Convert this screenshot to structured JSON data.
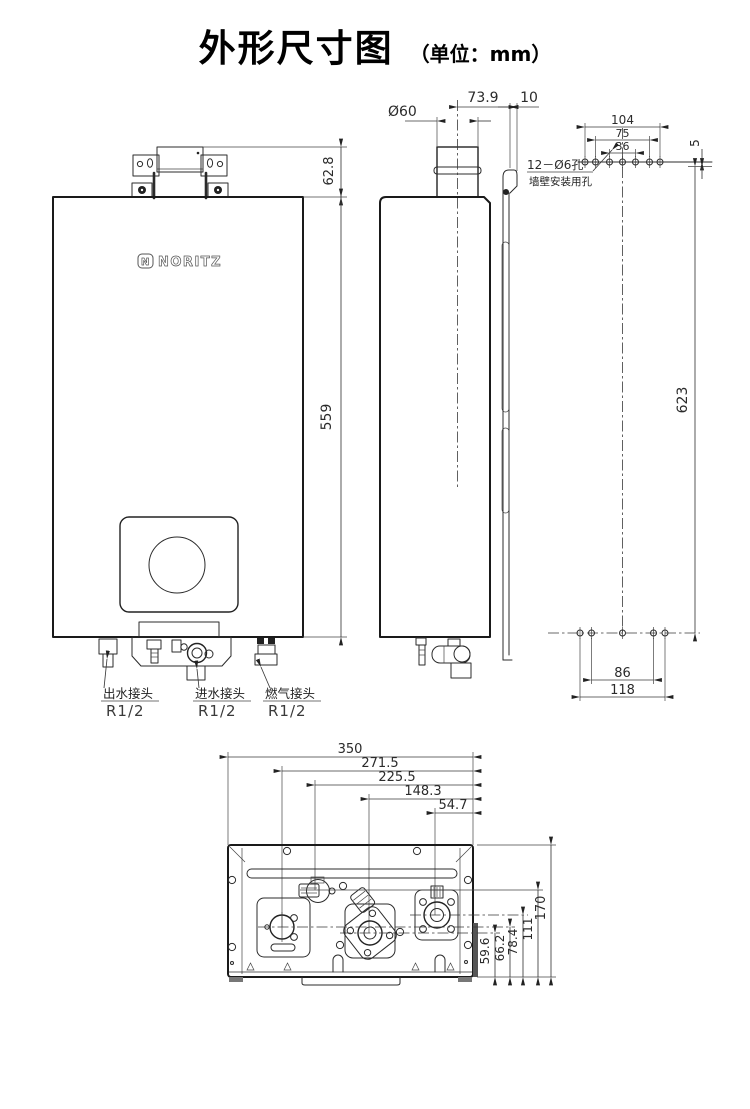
{
  "title": {
    "main": "外形尺寸图",
    "unit": "（单位：mm）"
  },
  "brand": {
    "name": "NORITZ",
    "mark": "N"
  },
  "front_view": {
    "dim_bracket_height": "62.8",
    "dim_body_height": "559",
    "connections": [
      {
        "label": "出水接头",
        "size": "R1/2"
      },
      {
        "label": "进水接头",
        "size": "R1/2"
      },
      {
        "label": "燃气接头",
        "size": "R1/2"
      }
    ]
  },
  "side_view": {
    "dim_flue_diameter": "Ø60",
    "dim_flue_to_back": "73.9",
    "dim_back_offset": "10"
  },
  "rear_view": {
    "dim_hole_span_outer": "104",
    "dim_hole_span_mid": "75",
    "dim_hole_span_inner": "36",
    "dim_top_offset": "5",
    "dim_hole_height": "623",
    "dim_bottom_span_inner": "86",
    "dim_bottom_span_outer": "118",
    "note_line1": "12－Ø6孔",
    "note_line2": "墙壁安装用孔"
  },
  "bottom_view": {
    "dim_width": "350",
    "dim_outlet_x": "271.5",
    "dim_drain_x": "225.5",
    "dim_inlet_x": "148.3",
    "dim_gas_x": "54.7",
    "dim_inlet_y": "59.6",
    "dim_outlet_y": "66.2",
    "dim_gas_y": "78.4",
    "dim_drain_y": "111",
    "dim_depth": "170"
  }
}
